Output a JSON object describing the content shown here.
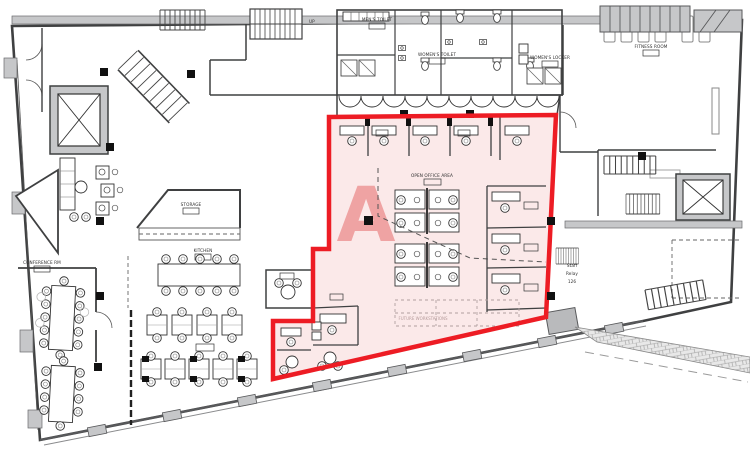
{
  "plan": {
    "zone_marker": "A",
    "labels": {
      "open_office": "OPEN OFFICE AREA",
      "future_ws": "FUTURE WORKSTATIONS",
      "kitchen": "KITCHEN",
      "storage": "STORAGE",
      "conference": "CONFERENCE RM",
      "fitness": "FITNESS ROOM",
      "womens_locker": "WOMEN'S LOCKER",
      "mens_toilet": "MEN'S TOILET",
      "womens_toilet": "WOMEN'S TOILET",
      "up": "UP",
      "staff_l1": "Staff",
      "staff_l2": "Relay",
      "staff_l3": "126"
    },
    "colors": {
      "zone_fill": "#fbe9e9",
      "zone_border": "#ed1c24",
      "zone_letter": "#efa3a3",
      "wall": "#3f4041",
      "poche": "#c6c7c9",
      "future_text": "#b79c9c"
    }
  }
}
